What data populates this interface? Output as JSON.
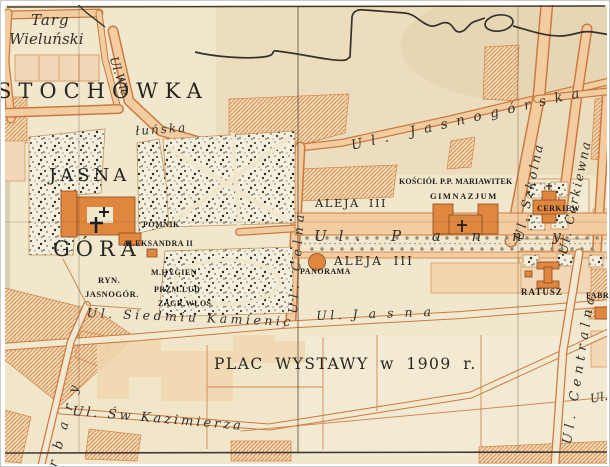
{
  "map": {
    "districts": {
      "czestochowka": "STOCHÓWKA",
      "jasna": "JASNA",
      "gora": "GÓRA"
    },
    "places": {
      "targ_line1": "Targ",
      "targ_line2": "Wieluński",
      "pomnik": "POMNIK",
      "aleksandra": "ALEKSANDRA II",
      "ryn": "RYN.",
      "jasnogor": "JASNOGÓR.",
      "m_hygien": "M.HYGIEN",
      "przm_lud": "PRZM.LUD",
      "zagr_wlos": "ZAGR.WŁOŚ",
      "kosciol_mariawitek": "KOŚCIÓŁ P.P. MARIAWITEK",
      "gimnazjum": "GIMNAZJUM",
      "cerkiew": "CERKIEW",
      "ratusz": "RATUSZ",
      "panorama": "PANORAMA",
      "fabr": "FABR",
      "aleja_north": "ALEJA III",
      "aleja_south": "ALEJA III",
      "plac_wystawy": "PLAC WYSTAWY w 1909 r."
    },
    "streets": {
      "wielunska_upper": "Ul.Wie",
      "wielunska_lower": "łuńska",
      "jasnogorska": "Ul. Jasnogórska",
      "szkolna": "Ul. Szkolna",
      "cerkiewna": "Ul. Cerkiewna",
      "celna": "Ul. Celna",
      "panny": "Ul. P a n n y",
      "jasna_street": "Ul. J a s n a",
      "siedmiu_kamienic": "Ul. Siedmiu Kamienic",
      "kazimierza": "Ul. Św Kazimierza",
      "centralna": "Ul. Centralna",
      "barbary_fragment": "rbary",
      "edge_fragment": "Ul."
    },
    "colors": {
      "paper": "#f0e7cd",
      "street_fill": "#f3cda0",
      "street_outline": "#c97a42",
      "building": "#e0873f",
      "ink": "#2b2a24"
    }
  }
}
